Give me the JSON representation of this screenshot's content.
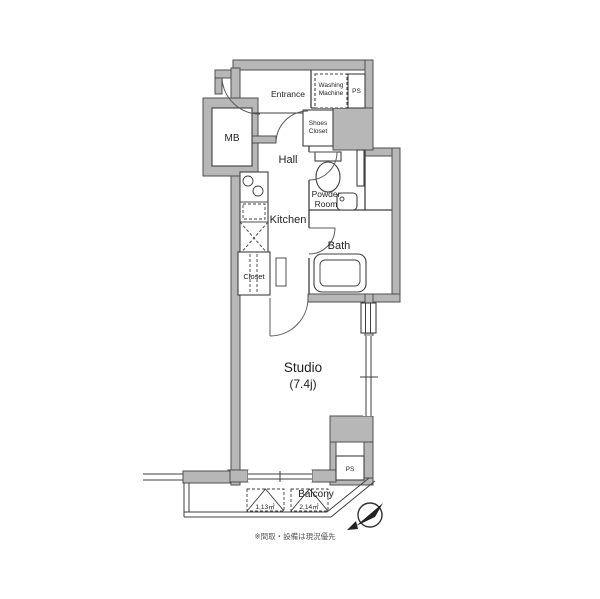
{
  "floorplan": {
    "labels": {
      "entrance": "Entrance",
      "washing_machine": [
        "Washing",
        "Machine"
      ],
      "ps_top": "PS",
      "shoes_closet": [
        "Shoes",
        "Closet"
      ],
      "mb": "MB",
      "hall": "Hall",
      "powder_room": [
        "Powder",
        "Room"
      ],
      "kitchen": "Kitchen",
      "bath": "Bath",
      "closet": "Closet",
      "studio": "Studio",
      "studio_size": "(7.4j)",
      "ps_bottom": "PS",
      "balcony": "Balcony",
      "balcony_unit_1": "1,13㎡",
      "balcony_unit_2": "2,14㎡",
      "note": "※間取・設備は現況優先"
    },
    "colors": {
      "wall_fill": "#b7b7b7",
      "outline": "#3f3f3f",
      "background": "#ffffff"
    }
  }
}
